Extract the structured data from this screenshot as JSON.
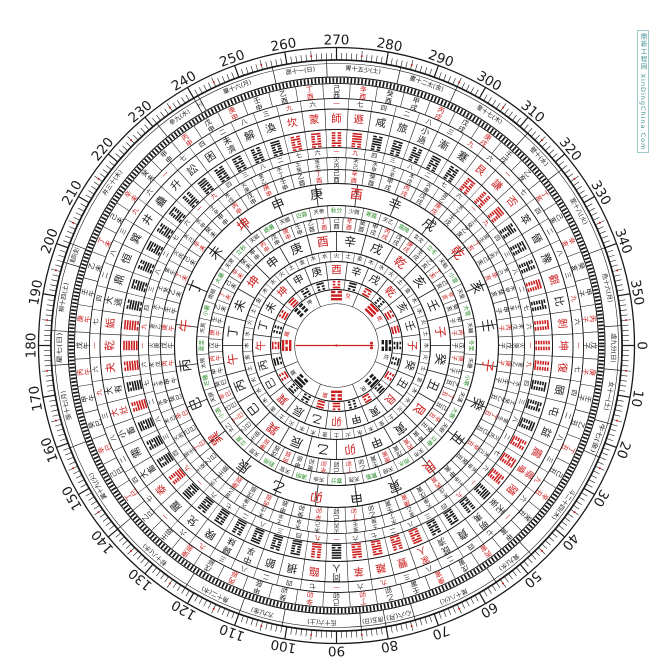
{
  "colors": {
    "ink": "#1a1a1a",
    "red": "#cc2020",
    "green": "#2f8f2f",
    "watermark": "#3d8f8f"
  },
  "watermark": {
    "text": "鼎新工程网 XinDingChina.Com"
  },
  "degree_ring": {
    "labels": [
      "0",
      "10",
      "20",
      "30",
      "40",
      "50",
      "60",
      "70",
      "80",
      "90",
      "100",
      "110",
      "120",
      "130",
      "140",
      "150",
      "160",
      "170",
      "180",
      "190",
      "200",
      "210",
      "220",
      "230",
      "240",
      "250",
      "260",
      "270",
      "280",
      "290",
      "300",
      "310",
      "320",
      "330",
      "340",
      "350"
    ]
  },
  "mansions": {
    "start_deg": -4,
    "items": [
      {
        "t": "虛九分(日)",
        "span": 9
      },
      {
        "t": "女十一(土)",
        "span": 11
      },
      {
        "t": "牛七(金)",
        "span": 7
      },
      {
        "t": "斗二十四(木)",
        "span": 24
      },
      {
        "t": "箕九(水)",
        "span": 9
      },
      {
        "t": "尾十八(火)",
        "span": 18
      },
      {
        "t": "心六(月)",
        "span": 6
      },
      {
        "t": "房五(日)",
        "span": 5
      },
      {
        "t": "氐十六(土)",
        "span": 16
      },
      {
        "t": "亢九(金)",
        "span": 9
      },
      {
        "t": "角十二(木)",
        "span": 12
      },
      {
        "t": "軫十八(水)",
        "span": 18
      },
      {
        "t": "翼十九(火)",
        "span": 19
      },
      {
        "t": "張十七(月)",
        "span": 17
      },
      {
        "t": "星七(日)",
        "span": 7
      },
      {
        "t": "柳十四(土)",
        "span": 14
      },
      {
        "t": "鬼四(金)",
        "span": 4
      },
      {
        "t": "井三十(木)",
        "span": 30
      },
      {
        "t": "參九(水)",
        "span": 9
      },
      {
        "t": "觜一(火)",
        "span": 1
      },
      {
        "t": "畢十六(月)",
        "span": 16
      },
      {
        "t": "昴十一(日)",
        "span": 11
      },
      {
        "t": "胃十五少(土)",
        "span": 15
      },
      {
        "t": "婁十二太(金)",
        "span": 12
      },
      {
        "t": "奎十七(木)",
        "span": 17
      },
      {
        "t": "壁十(水)",
        "span": 10
      },
      {
        "t": "室十八(火)",
        "span": 18
      },
      {
        "t": "危十六(月)",
        "span": 16
      }
    ]
  },
  "sixty_dragons": [
    "甲子",
    "丙子",
    "戊子",
    "庚子",
    "壬子",
    "乙丑",
    "丁丑",
    "己丑",
    "辛丑",
    "癸丑",
    "甲寅",
    "丙寅",
    "戊寅",
    "庚寅",
    "壬寅",
    "乙卯",
    "丁卯",
    "己卯",
    "辛卯",
    "癸卯",
    "甲辰",
    "丙辰",
    "戊辰",
    "庚辰",
    "壬辰",
    "乙巳",
    "丁巳",
    "己巳",
    "辛巳",
    "癸巳",
    "甲午",
    "丙午",
    "戊午",
    "庚午",
    "壬午",
    "乙未",
    "丁未",
    "己未",
    "辛未",
    "癸未",
    "甲申",
    "丙申",
    "戊申",
    "庚申",
    "壬申",
    "乙酉",
    "丁酉",
    "己酉",
    "辛酉",
    "癸酉",
    "甲戌",
    "丙戌",
    "戊戌",
    "庚戌",
    "壬戌",
    "乙亥",
    "丁亥",
    "己亥",
    "辛亥",
    "癸亥"
  ],
  "red_stems": [
    "丙",
    "丁",
    "庚",
    "辛"
  ],
  "mountains": {
    "items": [
      "子",
      "癸",
      "丑",
      "艮",
      "寅",
      "甲",
      "卯",
      "乙",
      "辰",
      "巽",
      "巳",
      "丙",
      "午",
      "丁",
      "未",
      "坤",
      "申",
      "庚",
      "酉",
      "辛",
      "戌",
      "乾",
      "亥",
      "壬"
    ],
    "red": [
      "子",
      "午",
      "卯",
      "酉",
      "乾",
      "坤",
      "艮",
      "巽"
    ]
  },
  "hexagrams": {
    "names": [
      "坤",
      "復",
      "頤",
      "屯",
      "益",
      "震",
      "噬嗑",
      "隨",
      "无妄",
      "明夷",
      "賁",
      "既濟",
      "家人",
      "豐",
      "離",
      "革",
      "同人",
      "臨",
      "損",
      "節",
      "中孚",
      "歸妹",
      "睽",
      "兌",
      "履",
      "泰",
      "大畜",
      "需",
      "小畜",
      "大壯",
      "大有",
      "夬",
      "乾",
      "姤",
      "大過",
      "鼎",
      "恒",
      "巽",
      "井",
      "蠱",
      "升",
      "訟",
      "困",
      "未濟",
      "解",
      "渙",
      "坎",
      "蒙",
      "師",
      "遯",
      "咸",
      "旅",
      "小過",
      "漸",
      "蹇",
      "艮",
      "謙",
      "否",
      "萃",
      "晉",
      "豫",
      "觀",
      "比",
      "剝"
    ],
    "red": [
      "坤",
      "復",
      "臨",
      "泰",
      "大壯",
      "夬",
      "乾",
      "姤",
      "遯",
      "否",
      "觀",
      "剝",
      "震",
      "噬嗑",
      "隨",
      "離",
      "革",
      "家人",
      "豐",
      "坎",
      "蒙",
      "師",
      "艮",
      "謙"
    ]
  },
  "numbers_outer_cycle": [
    "一",
    "七",
    "四",
    "二",
    "八",
    "三",
    "九",
    "六"
  ],
  "numbers_inner_cycle": [
    "一",
    "九",
    "四",
    "三",
    "八",
    "二",
    "七",
    "六"
  ],
  "red_numbers": [
    "一",
    "九"
  ],
  "nayin_cycle": [
    "土辛",
    "木戊",
    "火庚",
    "金乙",
    "水丁",
    "土癸",
    "金壬",
    "火丙",
    "木己",
    "水甲"
  ],
  "element_cycle": [
    "水",
    "火",
    "土",
    "金",
    "木"
  ],
  "solar_terms": [
    "冬至",
    "小寒",
    "大寒",
    "立春",
    "雨水",
    "驚蟄",
    "春分",
    "清明",
    "穀雨",
    "立夏",
    "小滿",
    "芒種",
    "夏至",
    "小暑",
    "大暑",
    "立秋",
    "處暑",
    "白露",
    "秋分",
    "寒露",
    "霜降",
    "立冬",
    "小雪",
    "大雪"
  ],
  "stars": [
    "天壘",
    "天漢",
    "天廚",
    "天市",
    "天棓",
    "天苑",
    "天命",
    "天官",
    "天罡",
    "太乙",
    "天屏",
    "太微",
    "天馬",
    "南極",
    "天常",
    "天鉞",
    "天關",
    "天帝",
    "少微",
    "天乙",
    "玄戈",
    "天魁",
    "天皇",
    "天輔"
  ],
  "trigram_lines": {
    "乾": [
      1,
      1,
      1
    ],
    "兌": [
      1,
      1,
      0
    ],
    "離": [
      1,
      0,
      1
    ],
    "震": [
      1,
      0,
      0
    ],
    "巽": [
      0,
      1,
      1
    ],
    "坎": [
      0,
      1,
      0
    ],
    "艮": [
      0,
      0,
      1
    ],
    "坤": [
      0,
      0,
      0
    ]
  },
  "eight_trigrams": [
    {
      "name": "坎",
      "red": false
    },
    {
      "name": "艮",
      "red": false
    },
    {
      "name": "震",
      "red": true
    },
    {
      "name": "巽",
      "red": false
    },
    {
      "name": "離",
      "red": true
    },
    {
      "name": "坤",
      "red": false
    },
    {
      "name": "兌",
      "red": true
    },
    {
      "name": "乾",
      "red": true
    }
  ],
  "trigram24_cycle": [
    "坎",
    "艮",
    "震",
    "巽",
    "離",
    "坤",
    "兌",
    "乾"
  ],
  "trigram24_red": [
    "震",
    "離",
    "兌",
    "乾"
  ]
}
